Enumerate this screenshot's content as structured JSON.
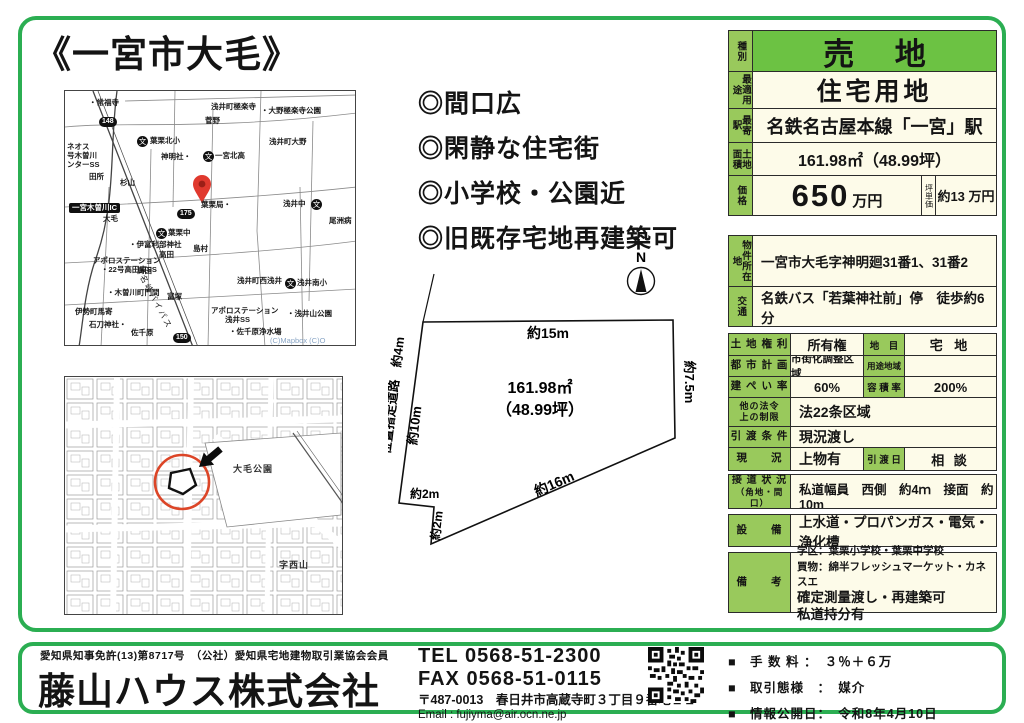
{
  "title": "《一宮市大毛》",
  "highlights": [
    "◎間口広",
    "◎閑静な住宅街",
    "◎小学校・公園近",
    "◎旧既存宅地再建築可"
  ],
  "maps": {
    "map1": {
      "labels": [
        {
          "x": 24,
          "y": 8,
          "t": "・常福寺"
        },
        {
          "x": 146,
          "y": 12,
          "t": "浅井町極楽寺"
        },
        {
          "x": 196,
          "y": 16,
          "t": "・大野極楽寺公園"
        },
        {
          "x": 140,
          "y": 26,
          "t": "菅野"
        },
        {
          "x": 85,
          "y": 46,
          "t": "葉栗北小"
        },
        {
          "x": 204,
          "y": 47,
          "t": "浅井町大野"
        },
        {
          "x": 96,
          "y": 62,
          "t": "神明社・"
        },
        {
          "x": 150,
          "y": 61,
          "t": "一宮北高"
        },
        {
          "x": 2,
          "y": 52,
          "t": "ネオス"
        },
        {
          "x": 2,
          "y": 61,
          "t": "号木曽川"
        },
        {
          "x": 2,
          "y": 70,
          "t": "ンターSS"
        },
        {
          "x": 24,
          "y": 82,
          "t": "田所"
        },
        {
          "x": 55,
          "y": 88,
          "t": "杉山"
        },
        {
          "x": 136,
          "y": 110,
          "t": "葉栗局・"
        },
        {
          "x": 218,
          "y": 109,
          "t": "浅井中"
        },
        {
          "x": 38,
          "y": 124,
          "t": "大毛"
        },
        {
          "x": 264,
          "y": 126,
          "t": "尾洲病"
        },
        {
          "x": 103,
          "y": 138,
          "t": "葉栗中"
        },
        {
          "x": 64,
          "y": 150,
          "t": "・伊富利部神社"
        },
        {
          "x": 128,
          "y": 154,
          "t": "島村"
        },
        {
          "x": 94,
          "y": 160,
          "t": "高田"
        },
        {
          "x": 28,
          "y": 166,
          "t": "アポロステーション"
        },
        {
          "x": 36,
          "y": 175,
          "t": "・22号高田東SS"
        },
        {
          "x": 72,
          "y": 176,
          "t": "高田"
        },
        {
          "x": 172,
          "y": 186,
          "t": "浅井町西浅井"
        },
        {
          "x": 232,
          "y": 188,
          "t": "浅井南小"
        },
        {
          "x": 42,
          "y": 198,
          "t": "・木曽川町門間"
        },
        {
          "x": 102,
          "y": 202,
          "t": "富塚"
        },
        {
          "x": 10,
          "y": 217,
          "t": "伊勢町馬寄"
        },
        {
          "x": 146,
          "y": 216,
          "t": "アポロステーション"
        },
        {
          "x": 160,
          "y": 225,
          "t": "浅井SS"
        },
        {
          "x": 222,
          "y": 219,
          "t": "・浅井山公園"
        },
        {
          "x": 24,
          "y": 230,
          "t": "石刀神社・"
        },
        {
          "x": 66,
          "y": 238,
          "t": "佐千原"
        },
        {
          "x": 164,
          "y": 237,
          "t": "・佐千原浄水場"
        },
        {
          "x": 80,
          "y": 183,
          "t": "名岐バイパス",
          "c": "rd",
          "r": 62
        },
        {
          "x": 205,
          "y": 246,
          "t": "(C)Mapbox (C)O",
          "c": "credit"
        },
        {
          "x": 34,
          "y": 26,
          "t": "148",
          "c": "badge"
        },
        {
          "x": 112,
          "y": 118,
          "t": "175",
          "c": "badge"
        },
        {
          "x": 108,
          "y": 242,
          "t": "150",
          "c": "badge"
        },
        {
          "x": 4,
          "y": 112,
          "t": "一宮木曽川IC",
          "c": "ic"
        },
        {
          "x": 72,
          "y": 45,
          "t": "文",
          "c": "school"
        },
        {
          "x": 138,
          "y": 60,
          "t": "文",
          "c": "school"
        },
        {
          "x": 91,
          "y": 137,
          "t": "文",
          "c": "school"
        },
        {
          "x": 246,
          "y": 108,
          "t": "文",
          "c": "school"
        },
        {
          "x": 220,
          "y": 187,
          "t": "文",
          "c": "school"
        }
      ]
    },
    "map2": {
      "labels": [
        {
          "x": 168,
          "y": 88,
          "t": "大毛公園",
          "c": "park"
        },
        {
          "x": 214,
          "y": 184,
          "t": "字西山",
          "c": "park"
        }
      ]
    }
  },
  "plot": {
    "north": "N",
    "area1": "161.98㎡",
    "area2": "（48.99坪）",
    "d_top": "約15m",
    "d_right": "約7.5m",
    "d_diag": "約16m",
    "d_left": "約10m",
    "d_road": "位置指定道路　約4m",
    "d_n1": "約2m",
    "d_n2": "約2m"
  },
  "t": {
    "shu_l": "種別",
    "shu_v": "売 地",
    "yo_l": "最適用途",
    "yo_v": "住宅用地",
    "eki_l": "最寄駅",
    "eki_v": "名鉄名古屋本線「一宮」駅",
    "men_l": "土地面積",
    "men_v": "161.98㎡（48.99坪）",
    "ka_l": "価格",
    "ka_num": "650",
    "ka_unit": "万円",
    "tsubo_l": "坪単価",
    "tsubo_v": "約13 万円",
    "sho_l": "物件所在地",
    "sho_v": "一宮市大毛字神明廻31番1、31番2",
    "ko_l": "交通",
    "ko_v": "名鉄バス「若葉神社前」停　徒歩約6分",
    "kenri_l": "土 地 権 利",
    "kenri_v": "所有権",
    "chimoku_l": "地　目",
    "chimoku_v": "宅 地",
    "toshi_l": "都 市 計 画",
    "toshi_v": "市街化調整区域",
    "yochi_l": "用途地域",
    "yochi_v": "",
    "kenpei_l": "建 ぺ い 率",
    "kenpei_v": "60%",
    "yoseki_l": "容 積 率",
    "yoseki_v": "200%",
    "hoka_l1": "他の法令",
    "hoka_l2": "上の制限",
    "hoka_v": "法22条区域",
    "hiki_l": "引 渡 条 件",
    "hiki_v": "現況渡し",
    "genkyo_l": "現　　況",
    "genkyo_v": "上物有",
    "hikibi_l": "引 渡 日",
    "hikibi_v": "相 談",
    "setsudo_l1": "接 道 状 況",
    "setsudo_l2": "（角地・間口）",
    "setsudo_v": "私道幅員　西側　約4ｍ　接面　約10m",
    "setsubi_l": "設　　備",
    "setsubi_v": "上水道・プロパンガス・電気・浄化槽",
    "biko_l": "備　　考",
    "biko_1": "学区：葉栗小学校・葉栗中学校",
    "biko_2": "買物：綿半フレッシュマーケット・カネスエ",
    "biko_3": "確定測量渡し・再建築可",
    "biko_4": "私道持分有"
  },
  "footer": {
    "license": "愛知県知事免許(13)第8717号　（公社）愛知県宅地建物取引業協会会員",
    "company": "藤山ハウス株式会社",
    "tel": "TEL  0568-51-2300",
    "fax": "FAX  0568-51-0115",
    "address": "〒487-0013　春日井市高蔵寺町３丁目９番地１１",
    "email": "Email : fujiyma@air.ocn.ne.jp",
    "notes": [
      "■　手 数 料 ：　３％＋６万",
      "■　取引態様　：　媒介",
      "■　情報公開日：　令和8年4月10日"
    ]
  }
}
